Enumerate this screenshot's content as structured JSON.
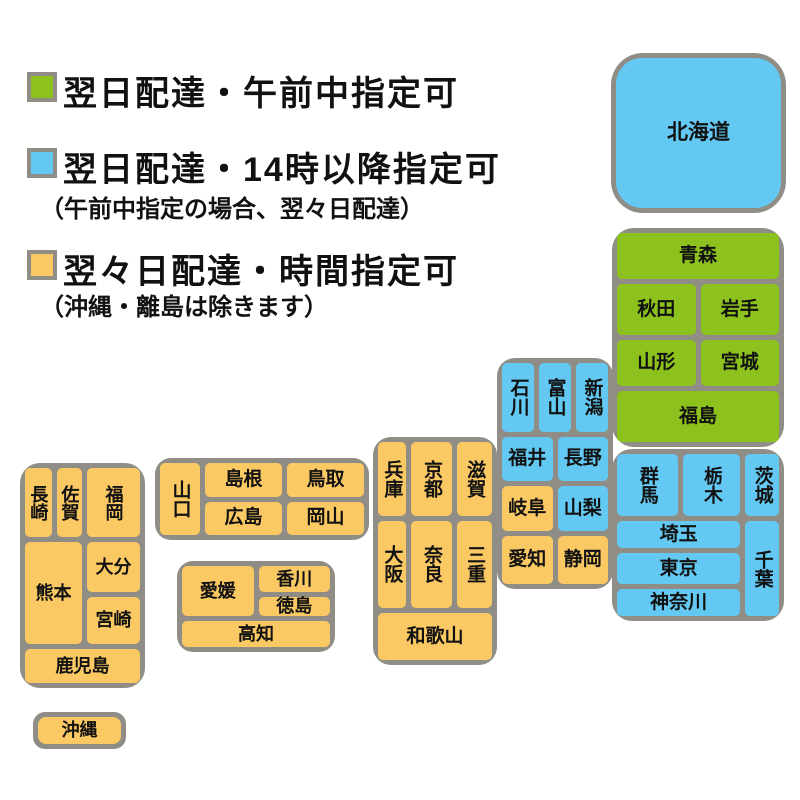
{
  "colors": {
    "green": "#8dc21e",
    "blue": "#63c9f2",
    "orange": "#fbc963",
    "border_gray": "#8f8d86",
    "text": "#111111",
    "background": "#ffffff"
  },
  "legend": {
    "items": [
      {
        "color_key": "green",
        "label": "翌日配達・午前中指定可",
        "note": ""
      },
      {
        "color_key": "blue",
        "label": "翌日配達・14時以降指定可",
        "note": "（午前中指定の場合、翌々日配達）"
      },
      {
        "color_key": "orange",
        "label": "翌々日配達・時間指定可",
        "note": "（沖縄・離島は除きます）"
      }
    ]
  },
  "map": {
    "regions": [
      {
        "id": "hokkaido",
        "cells": [
          {
            "label": "北海道",
            "color": "blue",
            "area": "hokkaido",
            "vertical": false
          }
        ]
      },
      {
        "id": "tohoku",
        "cells": [
          {
            "label": "青森",
            "color": "green",
            "area": "aomori",
            "vertical": false
          },
          {
            "label": "秋田",
            "color": "green",
            "area": "akita",
            "vertical": false
          },
          {
            "label": "岩手",
            "color": "green",
            "area": "iwate",
            "vertical": false
          },
          {
            "label": "山形",
            "color": "green",
            "area": "yamagata",
            "vertical": false
          },
          {
            "label": "宮城",
            "color": "green",
            "area": "miyagi",
            "vertical": false
          },
          {
            "label": "福島",
            "color": "green",
            "area": "fukushima",
            "vertical": false
          }
        ]
      },
      {
        "id": "kanto",
        "cells": [
          {
            "label": "群馬",
            "color": "blue",
            "area": "gunma",
            "vertical": true
          },
          {
            "label": "栃木",
            "color": "blue",
            "area": "tochigi",
            "vertical": true
          },
          {
            "label": "茨城",
            "color": "blue",
            "area": "ibaraki",
            "vertical": true
          },
          {
            "label": "埼玉",
            "color": "blue",
            "area": "saitama",
            "vertical": false
          },
          {
            "label": "東京",
            "color": "blue",
            "area": "tokyo",
            "vertical": false
          },
          {
            "label": "神奈川",
            "color": "blue",
            "area": "kanagawa",
            "vertical": false
          },
          {
            "label": "千葉",
            "color": "blue",
            "area": "chiba",
            "vertical": true
          }
        ]
      },
      {
        "id": "chubu",
        "cells": [
          {
            "label": "石川",
            "color": "blue",
            "area": "ishikawa",
            "vertical": true
          },
          {
            "label": "富山",
            "color": "blue",
            "area": "toyama",
            "vertical": true
          },
          {
            "label": "新潟",
            "color": "blue",
            "area": "niigata",
            "vertical": true
          },
          {
            "label": "福井",
            "color": "blue",
            "area": "fukui",
            "vertical": false
          },
          {
            "label": "長野",
            "color": "blue",
            "area": "nagano",
            "vertical": false
          },
          {
            "label": "岐阜",
            "color": "orange",
            "area": "gifu",
            "vertical": false
          },
          {
            "label": "山梨",
            "color": "blue",
            "area": "yamanashi",
            "vertical": false
          },
          {
            "label": "愛知",
            "color": "orange",
            "area": "aichi",
            "vertical": false
          },
          {
            "label": "静岡",
            "color": "orange",
            "area": "shizuoka",
            "vertical": false
          }
        ]
      },
      {
        "id": "kansai",
        "cells": [
          {
            "label": "兵庫",
            "color": "orange",
            "area": "hyogo",
            "vertical": true
          },
          {
            "label": "京都",
            "color": "orange",
            "area": "kyoto",
            "vertical": true
          },
          {
            "label": "滋賀",
            "color": "orange",
            "area": "shiga",
            "vertical": true
          },
          {
            "label": "大阪",
            "color": "orange",
            "area": "osaka",
            "vertical": true
          },
          {
            "label": "奈良",
            "color": "orange",
            "area": "nara",
            "vertical": true
          },
          {
            "label": "三重",
            "color": "orange",
            "area": "mie",
            "vertical": true
          },
          {
            "label": "和歌山",
            "color": "orange",
            "area": "wakayama",
            "vertical": false
          }
        ]
      },
      {
        "id": "chugoku",
        "cells": [
          {
            "label": "山口",
            "color": "orange",
            "area": "yamaguchi",
            "vertical": true
          },
          {
            "label": "島根",
            "color": "orange",
            "area": "shimane",
            "vertical": false
          },
          {
            "label": "鳥取",
            "color": "orange",
            "area": "tottori",
            "vertical": false
          },
          {
            "label": "広島",
            "color": "orange",
            "area": "hiroshima",
            "vertical": false
          },
          {
            "label": "岡山",
            "color": "orange",
            "area": "okayama",
            "vertical": false
          }
        ]
      },
      {
        "id": "shikoku",
        "cells": [
          {
            "label": "愛媛",
            "color": "orange",
            "area": "ehime",
            "vertical": false
          },
          {
            "label": "香川",
            "color": "orange",
            "area": "kagawa",
            "vertical": false
          },
          {
            "label": "徳島",
            "color": "orange",
            "area": "tokushima",
            "vertical": false
          },
          {
            "label": "高知",
            "color": "orange",
            "area": "kochi",
            "vertical": false
          }
        ]
      },
      {
        "id": "kyushu",
        "cells": [
          {
            "label": "長崎",
            "color": "orange",
            "area": "nagasaki",
            "vertical": true
          },
          {
            "label": "佐賀",
            "color": "orange",
            "area": "saga",
            "vertical": true
          },
          {
            "label": "福岡",
            "color": "orange",
            "area": "fukuoka",
            "vertical": true
          },
          {
            "label": "熊本",
            "color": "orange",
            "area": "kumamoto",
            "vertical": false
          },
          {
            "label": "大分",
            "color": "orange",
            "area": "oita",
            "vertical": false
          },
          {
            "label": "宮崎",
            "color": "orange",
            "area": "miyazaki",
            "vertical": false
          },
          {
            "label": "鹿児島",
            "color": "orange",
            "area": "kagoshima",
            "vertical": false
          }
        ]
      },
      {
        "id": "okinawa",
        "cells": [
          {
            "label": "沖縄",
            "color": "orange",
            "area": "okinawa",
            "vertical": false
          }
        ]
      }
    ]
  }
}
